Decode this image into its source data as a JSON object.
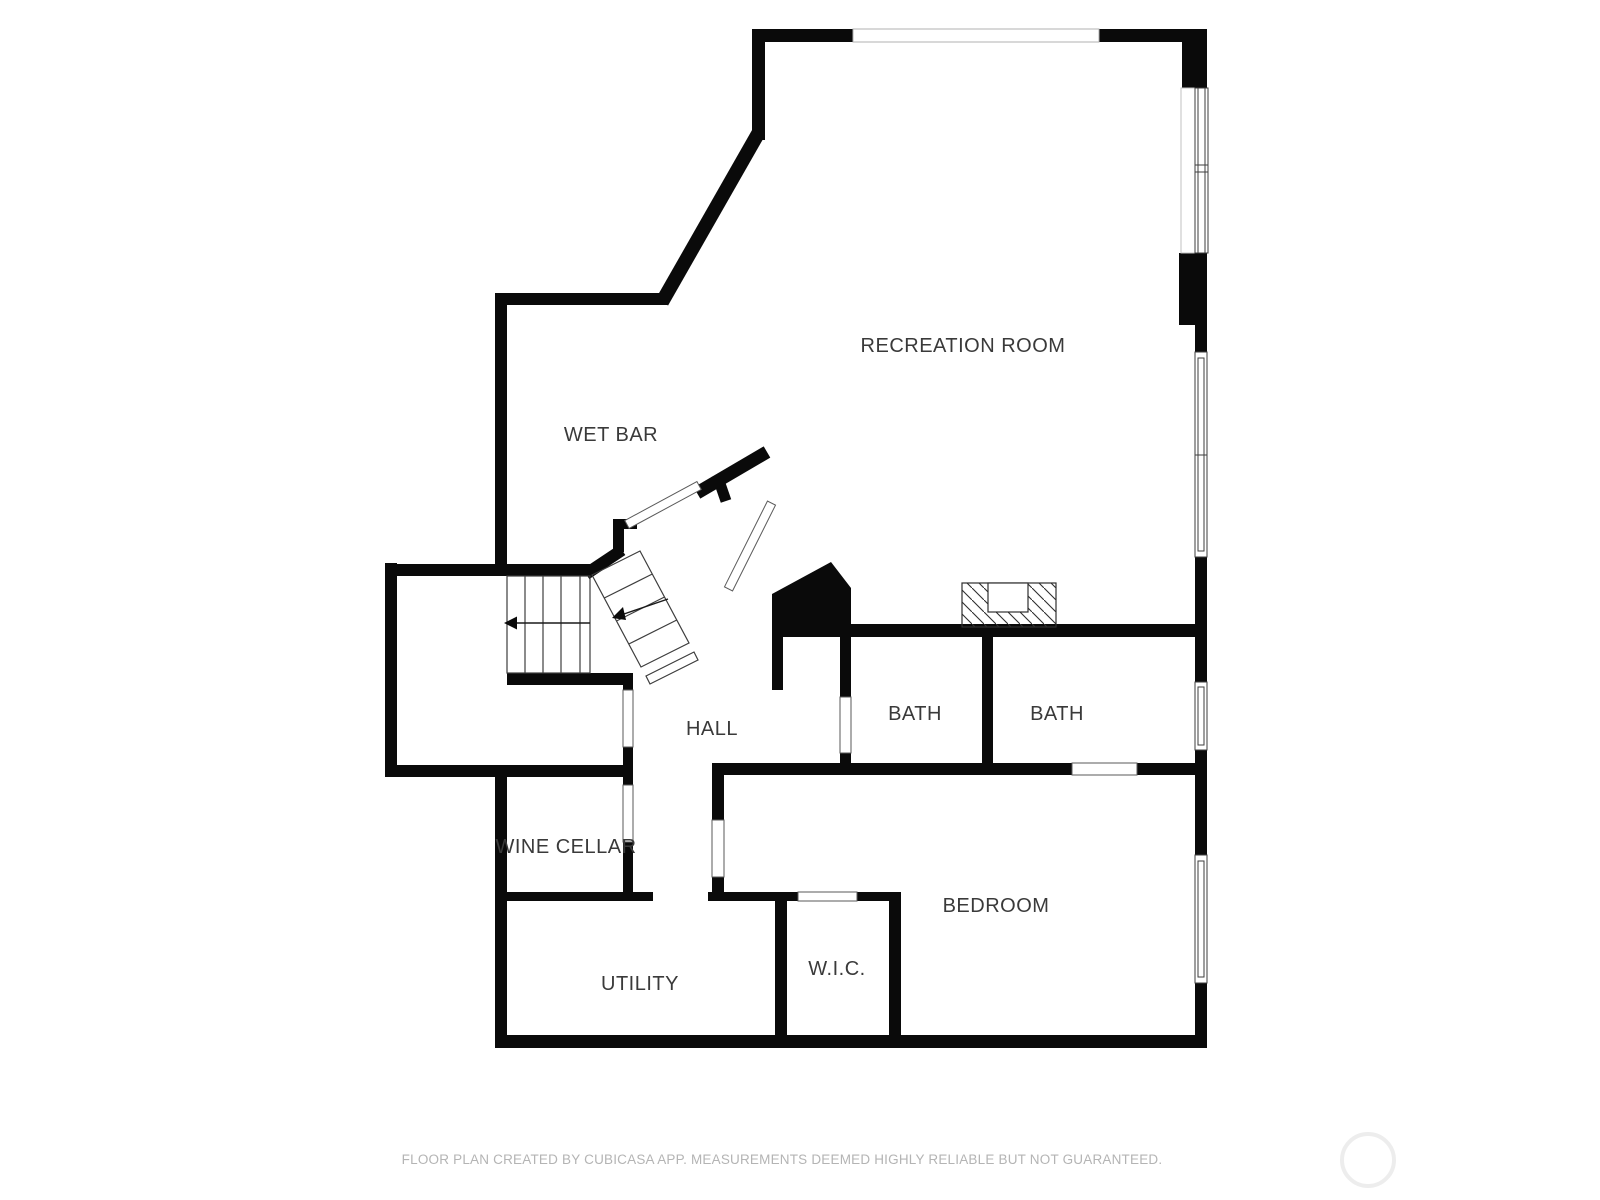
{
  "plan": {
    "type": "floor-plan",
    "level": "basement",
    "labels": {
      "recreation_room": "RECREATION ROOM",
      "wet_bar": "WET BAR",
      "hall": "HALL",
      "bath_1": "BATH",
      "bath_2": "BATH",
      "wine_cellar": "WINE CELLAR",
      "utility": "UTILITY",
      "wic": "W.I.C.",
      "bedroom": "BEDROOM"
    },
    "icons": {
      "fireplace": "hatched-masonry-block",
      "windows": "double-line-window-glyphs",
      "doors": "white-gap-openings",
      "stairs": "two-flights-with-direction-arrows",
      "logo": "faint-circle-watermark"
    }
  },
  "footer": {
    "disclaimer": "FLOOR PLAN CREATED BY CUBICASA APP. MEASUREMENTS DEEMED HIGHLY RELIABLE BUT NOT GUARANTEED."
  },
  "colors": {
    "background": "#ffffff",
    "wall": "#0a0a0a",
    "label_text": "#3a3a3a",
    "footer_text": "#b4b4b4",
    "logo_ring": "#ededed"
  }
}
